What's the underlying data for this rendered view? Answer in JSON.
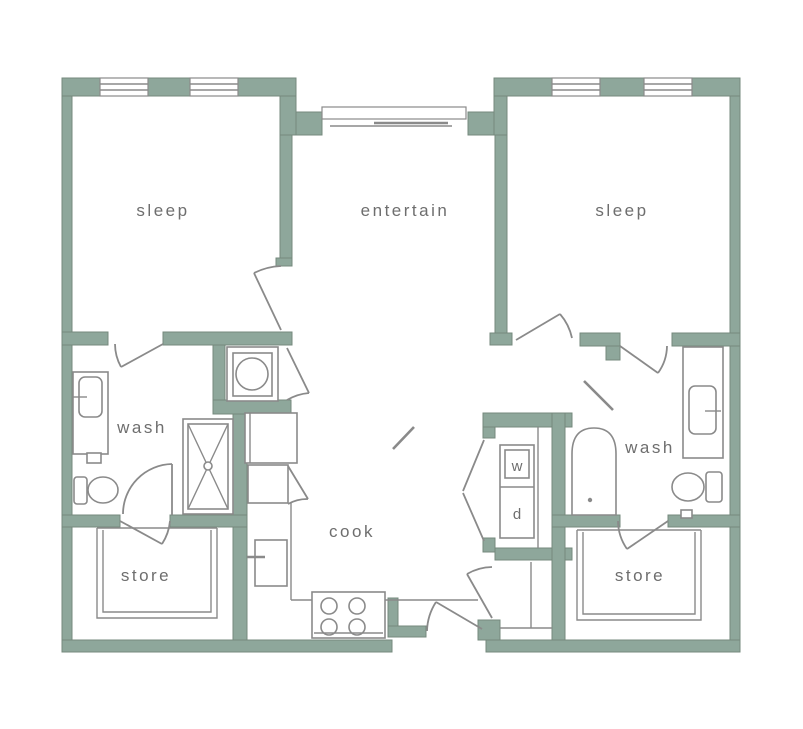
{
  "colors": {
    "wall": "#8EA79B",
    "wall_outline": "#75897C",
    "fixture_line": "#8A8A8A",
    "label": "#6E6E6E",
    "background": "#FFFFFF"
  },
  "rooms": {
    "sleep_left": {
      "label": "sleep"
    },
    "entertain": {
      "label": "entertain"
    },
    "sleep_right": {
      "label": "sleep"
    },
    "wash_left": {
      "label": "wash"
    },
    "cook": {
      "label": "cook"
    },
    "wash_right": {
      "label": "wash"
    },
    "store_left": {
      "label": "store"
    },
    "store_right": {
      "label": "store"
    }
  },
  "laundry": {
    "washer_label": "w",
    "dryer_label": "d"
  },
  "fixture_icons": [
    "window",
    "sliding-glass-door",
    "door-swing",
    "bifold-door",
    "toilet",
    "vanity-sink",
    "shower",
    "bathtub",
    "washing-machine",
    "washer-dryer-stack",
    "refrigerator",
    "kitchen-sink",
    "range-stove",
    "closet-shelving"
  ]
}
